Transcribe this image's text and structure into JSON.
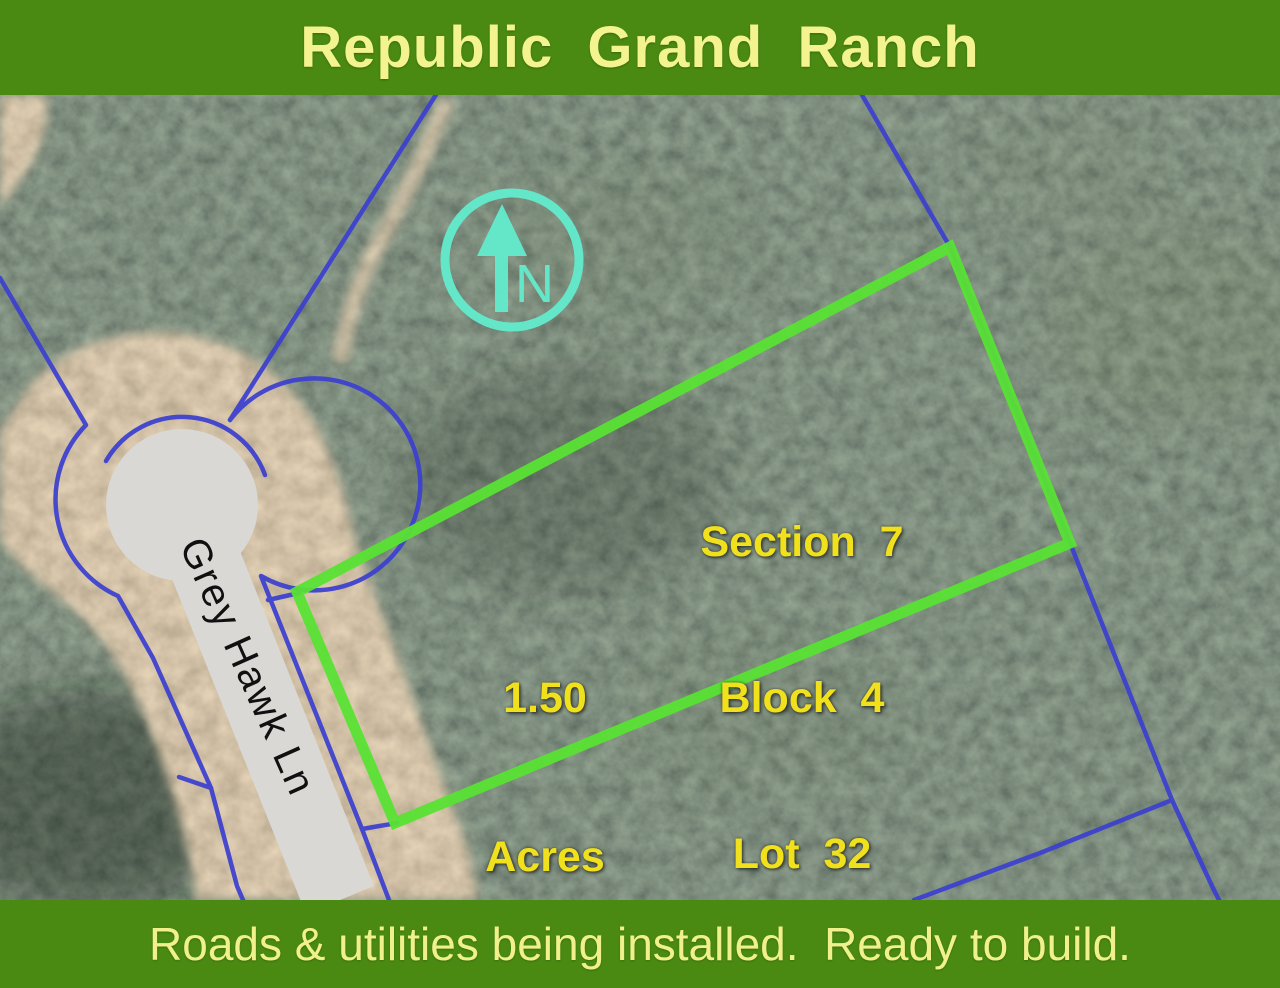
{
  "header": {
    "title": "Republic  Grand  Ranch"
  },
  "footer": {
    "tagline": "Roads & utilities being installed.  Ready to build."
  },
  "map": {
    "road_name": "Grey Hawk Ln",
    "compass": {
      "label": "N"
    },
    "lot": {
      "section": "Section  7",
      "block": "Block  4",
      "lot": "Lot  32",
      "acres_value": "1.50",
      "acres_unit": "Acres"
    },
    "colors": {
      "banner_green": "#4a8a12",
      "banner_text_yellow": "#f3f38f",
      "lot_text_yellow": "#f0e11c",
      "lot_outline_green": "#59e234",
      "property_line_blue": "#3b3fd0",
      "compass_cyan": "#63eccd",
      "road_gray": "#d9d8d5"
    }
  }
}
